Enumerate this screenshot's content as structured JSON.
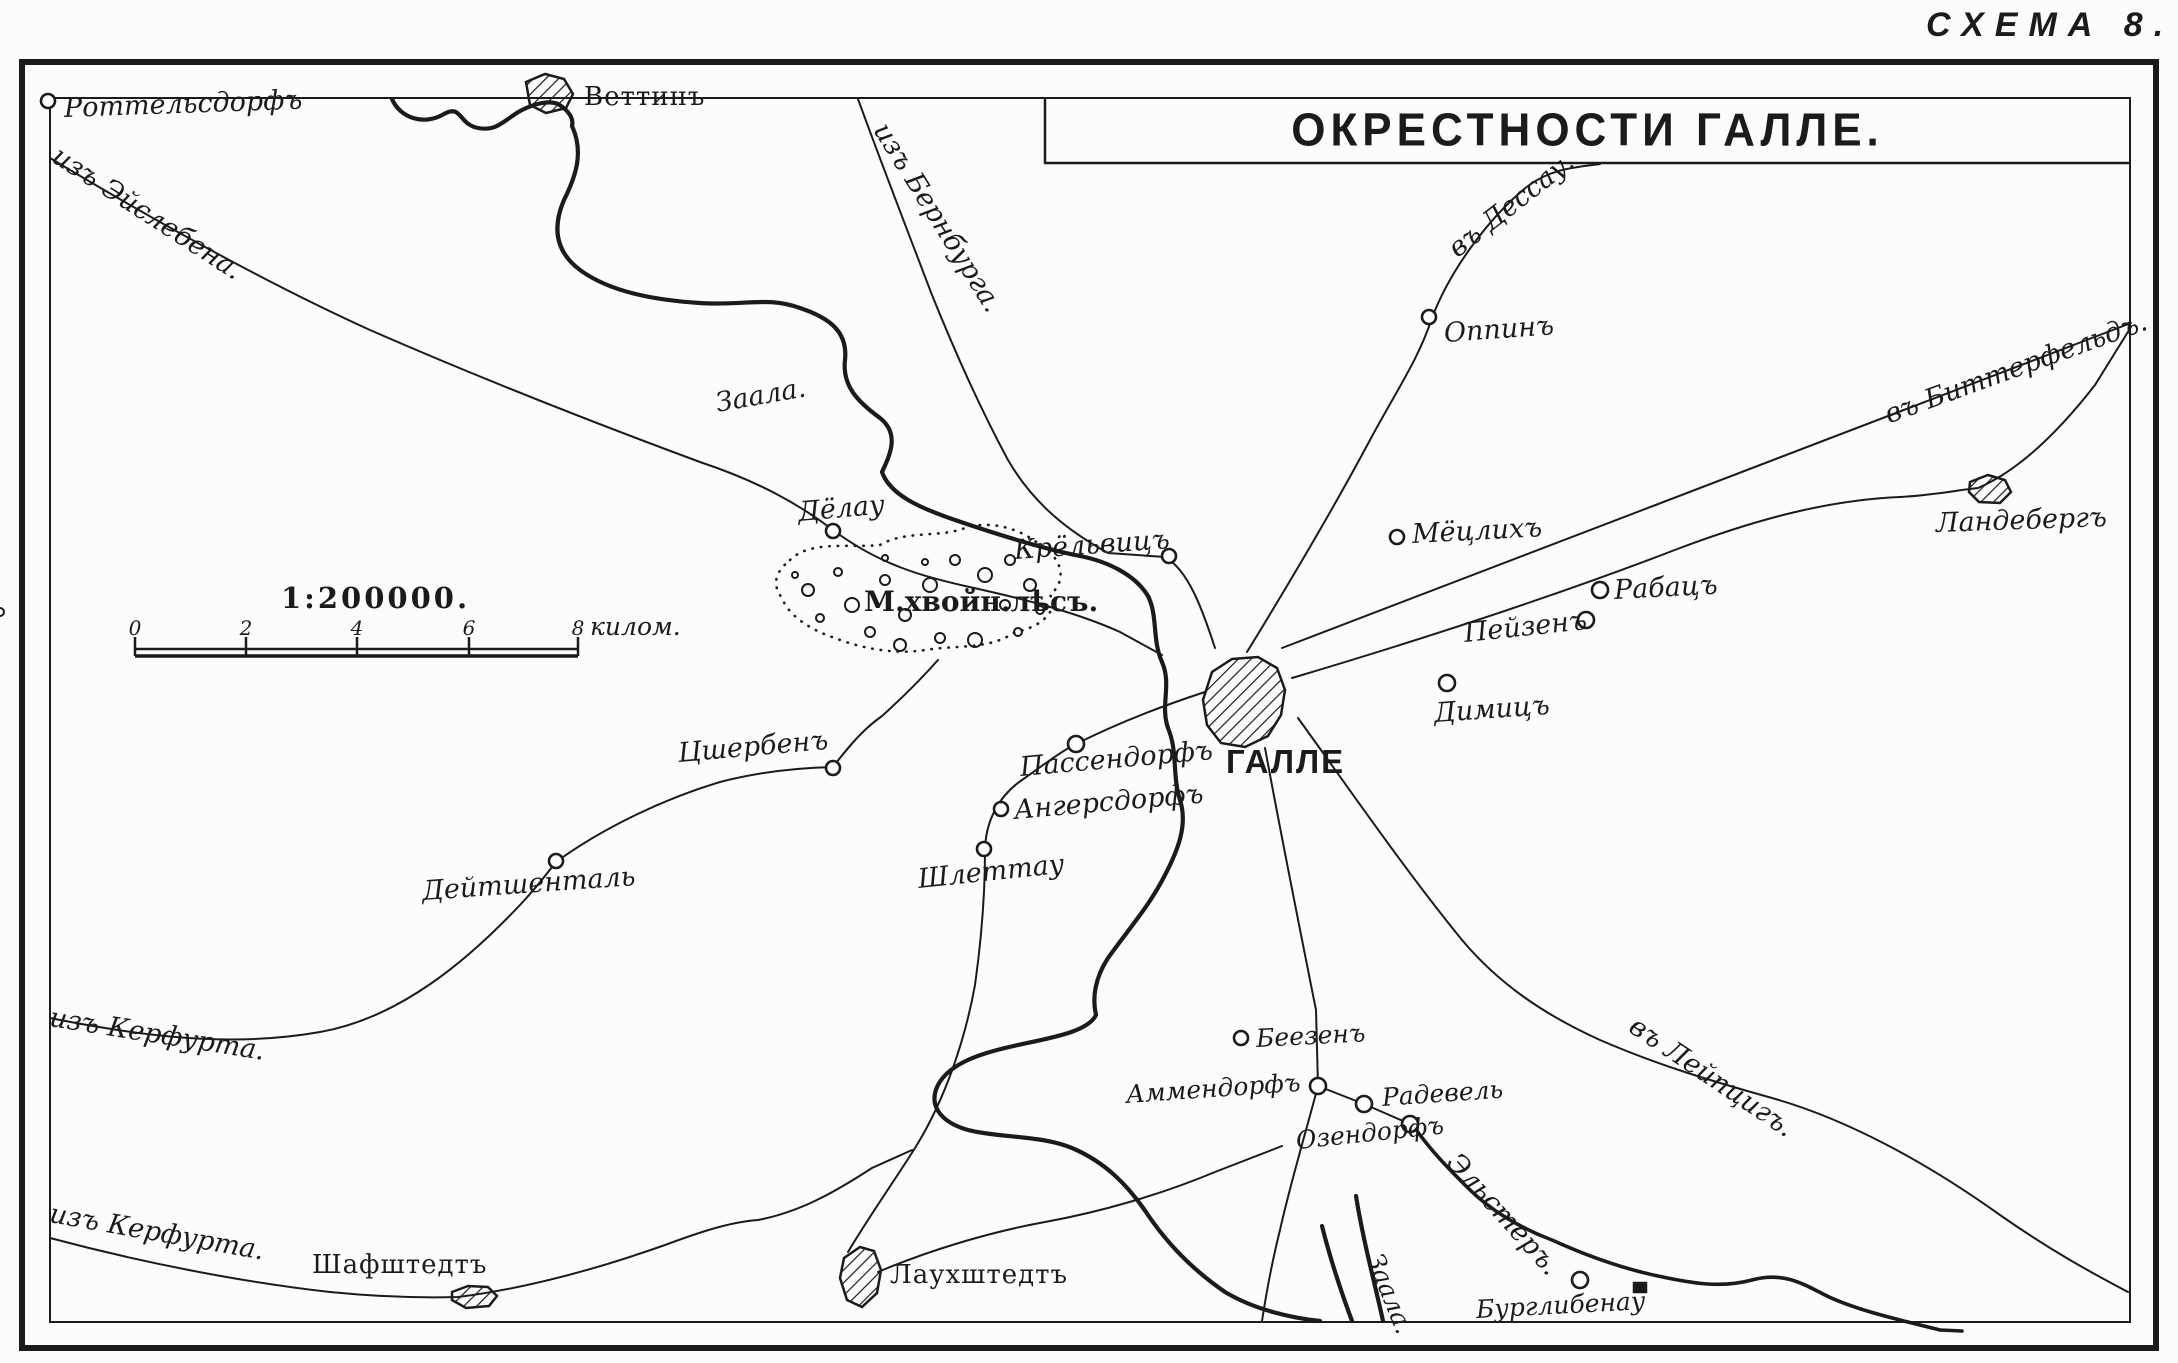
{
  "scheme_label": "СХЕМА 8.",
  "title": "ОКРЕСТНОСТИ ГАЛЛЕ.",
  "scale": {
    "ratio": "1:200000.",
    "ticks": [
      "0",
      "2",
      "4",
      "6",
      "8"
    ],
    "unit": "килом."
  },
  "forest_label": "М.хвойн.лѣсъ.",
  "places": {
    "rottelsdorf": "Роттельсдорфъ",
    "wettin": "Веттинъ",
    "oppin": "Оппинъ",
    "landeberg": "Ландебергъ",
    "delau": "Дёлау",
    "kroellwitz": "Крёльвицъ",
    "moetzlich": "Мёцлихъ",
    "rabatz": "Рабацъ",
    "peissen": "Пейзенъ",
    "diemitz": "Димицъ",
    "halle": "ГАЛЛЕ",
    "passendorf": "Пассендорфъ",
    "angersdorf": "Ангерсдорфъ",
    "zscherben": "Цшербенъ",
    "deutschenthal": "Дейтшенталь",
    "schlettau": "Шлеттау",
    "beesen": "Беезенъ",
    "ammendorf": "Аммендорфъ",
    "radewell": "Радевель",
    "osendorf": "Озендорфъ",
    "schafstedt": "Шафштедтъ",
    "lauchstedt": "Лаухштедтъ",
    "burgliebenau": "Бурглибенау"
  },
  "routes": {
    "iz_eislebena": "изъ Эйслебена.",
    "iz_bernburga": "изъ Бернбурга.",
    "v_dessau": "въ Дессау.",
    "v_bitterfeld": "въ Биттерфельдъ.",
    "v_leipzig": "въ Лейпцигъ.",
    "iz_kerfurta_mid": "изъ Керфурта.",
    "iz_kerfurta_bottom": "изъ Керфурта."
  },
  "rivers": {
    "saale_upper": "Заала.",
    "saale_lower": "Заала.",
    "elster": "Эльстеръ."
  }
}
